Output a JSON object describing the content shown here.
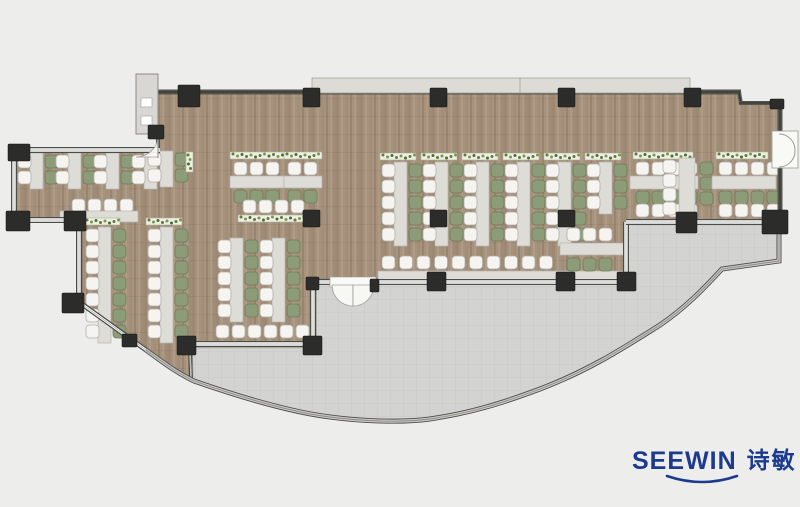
{
  "page": {
    "background": "#ededec"
  },
  "logo": {
    "brand": "SEEWIN",
    "chinese": "诗敏",
    "color": "#1c3b8e"
  },
  "floorplan": {
    "canvas": {
      "w": 800,
      "h": 507
    },
    "colors": {
      "background": "#ededec",
      "wood_base": "#a7927d",
      "wood_streaks": [
        "#9b8671",
        "#b19e88",
        "#a28d77",
        "#96816c",
        "#af9b85",
        "#9f8a74"
      ],
      "terrace": "#d3d3d1",
      "tile_line": "#c6c6c3",
      "wall_dark": "#55554f",
      "wall_edge": "#32322e",
      "win_dark": "#4c4c48",
      "win_core": "#ffffff",
      "win_center": "#a0a09b",
      "glass_outer": "#4e4e4b",
      "glass_mid": "#c9c8c4",
      "glass_inner": "#8e8d89",
      "column": "#2c2c2a",
      "chair_white": "#f6f4f0",
      "chair_white_stroke": "#b1aea7",
      "chair_green": "#8d9c78",
      "chair_green_stroke": "#6c7c58",
      "desk": "#dedcd7",
      "desk_stroke": "#b6b4af",
      "planter_bg": "#efeee6",
      "planter_stroke": "#abb196",
      "plant_dots": [
        "#5c7d36",
        "#7a9a48",
        "#486f2e"
      ],
      "band": "#dcdbd6",
      "band_stroke": "#a3a39e",
      "shaft_fill": "#d8d7d3",
      "shaft_stroke": "#8a8a86",
      "door_fill": "#f9f9f6",
      "door_stroke": "#9b9b95",
      "floor_outline": "#6b5f52"
    },
    "wood_path": "M159,92 L738,92 L742,104 L780,104 L780,224 L628,224 L628,284 L316,284 L316,347 L192,347 L192,381 L146,350 L82,303 L82,222 L16,222 L16,152 L158,152 L158,92 Z",
    "terrace_path": "M192,348 L314,348 L314,286 L626,286 L626,225 L778,225 L778,261 L722,269 C706,286 688,306 660,325 C625,347 590,370 540,389 C500,404 470,413 430,419 C400,423 360,421 330,417 C290,412 240,397 194,381 Z",
    "glass_curve": "M146,350 C160,360 175,372 194,381 C240,397 290,412 330,417 C360,421 400,423 430,419 C470,413 500,404 540,389 C590,370 625,347 660,325 C688,306 706,286 722,269 L779,261 L779,226",
    "window_band": {
      "x": 312,
      "y": 78,
      "w": 378,
      "h": 15,
      "divider_x": 520
    },
    "shaft": {
      "x": 136,
      "y": 74,
      "w": 22,
      "h": 60,
      "boxes": [
        [
          141,
          98,
          11,
          9
        ],
        [
          141,
          116,
          11,
          9
        ]
      ]
    },
    "walls": [
      {
        "x1": 158,
        "y1": 92,
        "x2": 741,
        "y2": 92,
        "t": 5,
        "s": "solid"
      },
      {
        "x1": 739,
        "y1": 92,
        "x2": 741,
        "y2": 104,
        "t": 4,
        "s": "solid"
      },
      {
        "x1": 739,
        "y1": 103,
        "x2": 781,
        "y2": 103,
        "t": 4,
        "s": "solid"
      },
      {
        "x1": 780,
        "y1": 101,
        "x2": 780,
        "y2": 134,
        "t": 5,
        "s": "solid"
      },
      {
        "x1": 780,
        "y1": 166,
        "x2": 780,
        "y2": 225,
        "t": 5,
        "s": "solid"
      },
      {
        "x1": 158,
        "y1": 134,
        "x2": 158,
        "y2": 152,
        "t": 4,
        "s": "solid"
      },
      {
        "x1": 14,
        "y1": 150,
        "x2": 160,
        "y2": 150,
        "t": 6,
        "s": "win"
      },
      {
        "x1": 14,
        "y1": 150,
        "x2": 14,
        "y2": 221,
        "t": 6,
        "s": "win"
      },
      {
        "x1": 14,
        "y1": 220,
        "x2": 80,
        "y2": 220,
        "t": 6,
        "s": "win"
      },
      {
        "x1": 79,
        "y1": 220,
        "x2": 79,
        "y2": 303,
        "t": 6,
        "s": "win"
      },
      {
        "x1": 79,
        "y1": 302,
        "x2": 146,
        "y2": 350,
        "t": 5,
        "s": "win"
      },
      {
        "x1": 186,
        "y1": 344,
        "x2": 316,
        "y2": 344,
        "t": 6,
        "s": "win"
      },
      {
        "x1": 313,
        "y1": 283,
        "x2": 313,
        "y2": 345,
        "t": 6,
        "s": "win"
      },
      {
        "x1": 313,
        "y1": 282,
        "x2": 332,
        "y2": 282,
        "t": 6,
        "s": "win"
      },
      {
        "x1": 372,
        "y1": 282,
        "x2": 629,
        "y2": 282,
        "t": 6,
        "s": "win"
      },
      {
        "x1": 626,
        "y1": 222,
        "x2": 626,
        "y2": 283,
        "t": 6,
        "s": "win"
      },
      {
        "x1": 626,
        "y1": 222,
        "x2": 781,
        "y2": 222,
        "t": 6,
        "s": "win"
      },
      {
        "x1": 190,
        "y1": 346,
        "x2": 191,
        "y2": 380,
        "t": 4,
        "s": "win"
      }
    ],
    "columns": [
      [
        178,
        85,
        22,
        22
      ],
      [
        303,
        88,
        17,
        19
      ],
      [
        430,
        88,
        17,
        19
      ],
      [
        558,
        88,
        17,
        19
      ],
      [
        684,
        88,
        17,
        19
      ],
      [
        770,
        99,
        14,
        10
      ],
      [
        303,
        210,
        17,
        17
      ],
      [
        430,
        210,
        17,
        17
      ],
      [
        558,
        210,
        17,
        17
      ],
      [
        676,
        212,
        21,
        21
      ],
      [
        762,
        210,
        26,
        24
      ],
      [
        617,
        272,
        19,
        19
      ],
      [
        556,
        272,
        19,
        19
      ],
      [
        427,
        272,
        19,
        19
      ],
      [
        306,
        277,
        13,
        13
      ],
      [
        370,
        279,
        9,
        13
      ],
      [
        177,
        336,
        19,
        19
      ],
      [
        303,
        336,
        19,
        19
      ],
      [
        8,
        144,
        22,
        17
      ],
      [
        6,
        211,
        24,
        20
      ],
      [
        64,
        211,
        22,
        20
      ],
      [
        62,
        293,
        22,
        20
      ],
      [
        148,
        125,
        16,
        14
      ],
      [
        122,
        334,
        15,
        13
      ]
    ],
    "doors": [
      {
        "kind": "double-right",
        "rect": [
          772,
          131,
          26,
          37
        ],
        "arcs": [
          "M779,134 A16,16 0 0 1 795,150",
          "M779,167 A16,16 0 0 0 795,150"
        ]
      },
      {
        "kind": "double-terrace",
        "cover": [
          330,
          277,
          46,
          10
        ],
        "wedges": [
          "M332,285 A21,21 0 0 0 353,306 L353,285 Z",
          "M374,285 A21,21 0 0 1 353,306 L353,285 Z"
        ]
      },
      {
        "kind": "single-topleft",
        "wedge": "M158,136 A22,21 0 0 1 136,157 L158,157 Z",
        "leaf": [
          158,
          134,
          158,
          158
        ]
      }
    ],
    "clusters": [
      {
        "t": "vrun",
        "x": 18,
        "y": 155,
        "seats": 2,
        "planter": false
      },
      {
        "t": "vrun",
        "x": 56,
        "y": 155,
        "seats": 2,
        "planter": false
      },
      {
        "t": "vrun",
        "x": 94,
        "y": 155,
        "seats": 2,
        "planter": false
      },
      {
        "t": "vrun",
        "x": 132,
        "y": 155,
        "seats": 2,
        "planter": false
      },
      {
        "t": "vrun",
        "x": 148,
        "y": 153,
        "seats": 2,
        "planter": false
      },
      {
        "t": "vplanter",
        "x": 186,
        "y": 152,
        "h": 20
      },
      {
        "t": "hrow",
        "x": 72,
        "y": 199,
        "n": 4,
        "c": "w"
      },
      {
        "t": "hdesk",
        "x": 60,
        "y": 211,
        "w": 78,
        "h": 11
      },
      {
        "t": "vrun",
        "x": 86,
        "y": 229,
        "seats": 7,
        "planter": true
      },
      {
        "t": "vrun",
        "x": 148,
        "y": 229,
        "seats": 7,
        "planter": true
      },
      {
        "t": "hcluster",
        "x": 230,
        "y": 152,
        "n": 3
      },
      {
        "t": "hcluster",
        "x": 284,
        "y": 152,
        "n": 2
      },
      {
        "t": "hrow",
        "x": 243,
        "y": 200,
        "n": 4,
        "c": "w"
      },
      {
        "t": "hplanter",
        "x": 238,
        "y": 215,
        "w": 74
      },
      {
        "t": "vrun",
        "x": 218,
        "y": 240,
        "seats": 5,
        "planter": false
      },
      {
        "t": "vrun",
        "x": 260,
        "y": 240,
        "seats": 5,
        "planter": false
      },
      {
        "t": "hrow",
        "x": 216,
        "y": 325,
        "n": 6,
        "c": "w"
      },
      {
        "t": "vrun",
        "x": 382,
        "y": 164,
        "seats": 5,
        "planter": true
      },
      {
        "t": "vrun",
        "x": 423,
        "y": 164,
        "seats": 5,
        "planter": true
      },
      {
        "t": "vrun",
        "x": 464,
        "y": 164,
        "seats": 5,
        "planter": true
      },
      {
        "t": "vrun",
        "x": 505,
        "y": 164,
        "seats": 5,
        "planter": true
      },
      {
        "t": "vrun",
        "x": 546,
        "y": 164,
        "seats": 5,
        "planter": true
      },
      {
        "t": "vrun",
        "x": 587,
        "y": 164,
        "seats": 3,
        "planter": true
      },
      {
        "t": "hrow",
        "x": 382,
        "y": 256,
        "n": 10,
        "c": "w",
        "sp": 17.5
      },
      {
        "t": "hdesk",
        "x": 378,
        "y": 271,
        "w": 250,
        "h": 9
      },
      {
        "t": "hrow",
        "x": 567,
        "y": 228,
        "n": 3,
        "c": "w"
      },
      {
        "t": "hdesk",
        "x": 560,
        "y": 243,
        "w": 64,
        "h": 12
      },
      {
        "t": "hrow",
        "x": 567,
        "y": 258,
        "n": 3,
        "c": "g"
      },
      {
        "t": "vcol",
        "x": 700,
        "y": 162,
        "n": 3,
        "c": "g",
        "sp": 15
      },
      {
        "t": "hplanter",
        "x": 633,
        "y": 152,
        "w": 60
      },
      {
        "t": "hrow",
        "x": 636,
        "y": 162,
        "n": 4,
        "c": "w"
      },
      {
        "t": "hdesk",
        "x": 630,
        "y": 176,
        "w": 68,
        "h": 13
      },
      {
        "t": "hrow",
        "x": 636,
        "y": 191,
        "n": 4,
        "c": "g"
      },
      {
        "t": "hrow",
        "x": 636,
        "y": 204,
        "n": 4,
        "c": "w"
      },
      {
        "t": "vdesk",
        "x": 679,
        "y": 158,
        "w": 16,
        "h": 56
      },
      {
        "t": "vcol",
        "x": 663,
        "y": 160,
        "n": 4,
        "c": "w",
        "sp": 14
      },
      {
        "t": "hplanter",
        "x": 716,
        "y": 152,
        "w": 52
      },
      {
        "t": "hrow",
        "x": 719,
        "y": 162,
        "n": 4,
        "c": "w"
      },
      {
        "t": "hdesk",
        "x": 712,
        "y": 176,
        "w": 64,
        "h": 13
      },
      {
        "t": "hrow",
        "x": 719,
        "y": 191,
        "n": 4,
        "c": "g"
      },
      {
        "t": "hrow",
        "x": 719,
        "y": 204,
        "n": 4,
        "c": "w"
      }
    ]
  }
}
